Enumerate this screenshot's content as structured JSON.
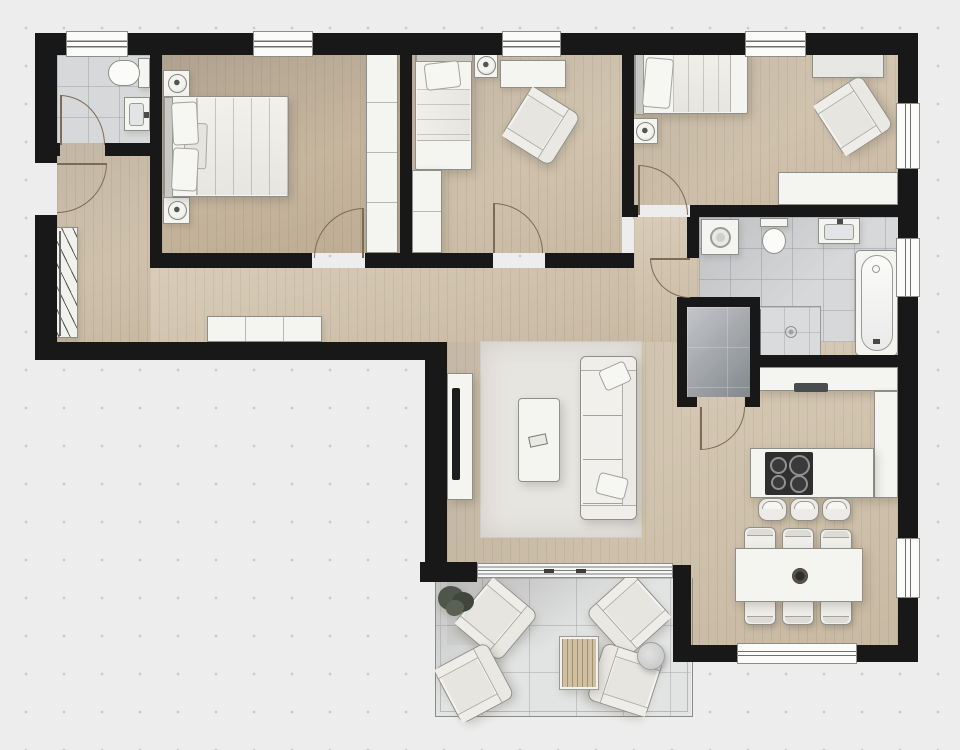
{
  "app": {
    "type": "architectural-floor-plan",
    "view": "top-down-2d-render",
    "canvas_px": {
      "width": 960,
      "height": 750
    },
    "visible_text": "none"
  },
  "palette": {
    "background": "#ecedec",
    "grid_dot": "#c7ccca",
    "wall_black": "#181818",
    "wood_floor": "#d2c4ad",
    "bath_tile": "#d7d8da",
    "storage_tile_light": "#c3c6c9",
    "storage_tile_dark": "#83888c",
    "terrace_tile": "#e2e3e3",
    "furniture_white": "#f4f4f1",
    "furniture_outline": "#8f8f89",
    "rug_grey": "#e7e5e0",
    "appliance_dark": "#2f2f2f",
    "door_swing_arc": "#7c6b57",
    "window_glass_line": "#6f6f6f",
    "plant_green": "#4b5148"
  },
  "rooms": [
    {
      "id": "bathroom-small",
      "position": "top-left",
      "floor": "tile",
      "fixtures": [
        "toilet",
        "washbasin",
        "door",
        "window"
      ]
    },
    {
      "id": "master-bedroom",
      "position": "top-left-center",
      "floor": "wood",
      "fixtures": [
        "double-bed",
        "pillow",
        "pillow",
        "throw-blanket",
        "nightstand-with-lamp",
        "nightstand-with-lamp",
        "wardrobe",
        "door",
        "window"
      ]
    },
    {
      "id": "bedroom-2",
      "position": "top-center",
      "floor": "wood",
      "fixtures": [
        "single-bed",
        "nightstand-with-lamp",
        "sideboard",
        "armchair",
        "wardrobe",
        "door",
        "window"
      ]
    },
    {
      "id": "bedroom-3",
      "position": "top-right",
      "floor": "wood",
      "fixtures": [
        "single-bed",
        "nightstand-with-lamp",
        "sideboard",
        "armchair",
        "desk-sideboard",
        "door",
        "window",
        "window"
      ]
    },
    {
      "id": "bathroom-main",
      "position": "right-middle",
      "floor": "tile",
      "fixtures": [
        "washing-machine",
        "toilet",
        "washbasin",
        "bathtub",
        "shower",
        "door",
        "window"
      ]
    },
    {
      "id": "storage-closet",
      "position": "center-right",
      "floor": "dark-tile",
      "fixtures": [
        "door"
      ]
    },
    {
      "id": "hallway",
      "position": "left-middle",
      "floor": "wood",
      "fixtures": [
        "entrance-door",
        "coat-rack",
        "sideboard"
      ]
    },
    {
      "id": "living-room",
      "position": "center",
      "floor": "wood",
      "fixtures": [
        "area-rug",
        "sofa",
        "throw-pillow",
        "throw-pillow",
        "coffee-table",
        "remote-control",
        "tv-sideboard",
        "tv"
      ]
    },
    {
      "id": "kitchen",
      "position": "right-center",
      "floor": "wood",
      "fixtures": [
        "counter-top-run",
        "counter-right-run",
        "island-peninsula",
        "cooktop-4-burners",
        "sink",
        "bar-stool",
        "bar-stool",
        "bar-stool"
      ]
    },
    {
      "id": "dining-area",
      "position": "bottom-right",
      "floor": "wood",
      "fixtures": [
        "dining-table",
        "centerpiece-bowl",
        "chair",
        "chair",
        "chair",
        "chair",
        "chair",
        "chair",
        "window",
        "window"
      ]
    },
    {
      "id": "terrace",
      "position": "bottom-center",
      "floor": "terrace-tile",
      "fixtures": [
        "sliding-glass-door",
        "railing",
        "potted-plant",
        "lounge-chair",
        "lounge-chair",
        "lounge-chair",
        "lounge-chair",
        "slatted-wood-table",
        "round-side-table"
      ]
    }
  ],
  "openings": {
    "windows_top_wall": 4,
    "windows_right_wall": 3,
    "windows_bottom_wall": 1,
    "interior_swing_doors": 6,
    "entrance_door": 1,
    "sliding_glass_door": 1
  }
}
